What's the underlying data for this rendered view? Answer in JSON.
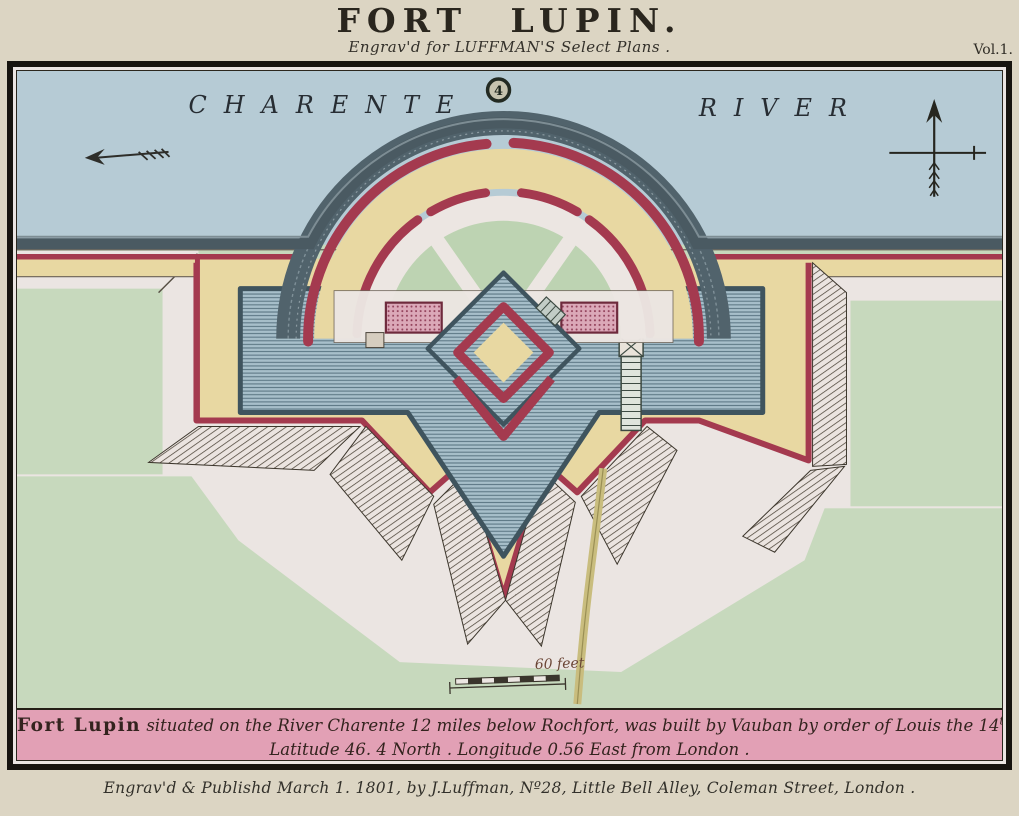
{
  "header": {
    "title": "FORT LUPIN.",
    "subtitle": "Engrav'd for LUFFMAN'S Select Plans .",
    "volume": "Vol.1."
  },
  "map": {
    "river_label_left": "CHARENTE",
    "river_label_right": "RIVER",
    "plate_number": "4",
    "scale_label": "60 feet"
  },
  "caption": {
    "lead": "Fort Lupin",
    "line1_rest": " situated on the River Charente 12 miles below Rochfort, was built by Vauban by order of Louis the 14",
    "line1_sup": "th",
    "line2": "Latitude 46. 4 North . Longitude 0.56 East from London ."
  },
  "imprint": "Engrav'd & Publishd March 1. 1801, by J.Luffman, Nº28, Little Bell Alley, Coleman Street, London .",
  "colors": {
    "paper": "#dcd5c3",
    "ink": "#2e2b24",
    "frame": "#17140f",
    "river": "#b6cbd5",
    "green": "#c7d9bd",
    "pale": "#ebe5e2",
    "yellow": "#e8d8a2",
    "crimson": "#a43a4f",
    "moat_fill": "#a7bfca",
    "moat_line": "#5d7885",
    "dark_band": "#4a5a62",
    "pink_band": "#e2a0b5",
    "pink_building": "#dba8b8",
    "road": "#c9bd7e",
    "hatch": "#4b4337"
  }
}
